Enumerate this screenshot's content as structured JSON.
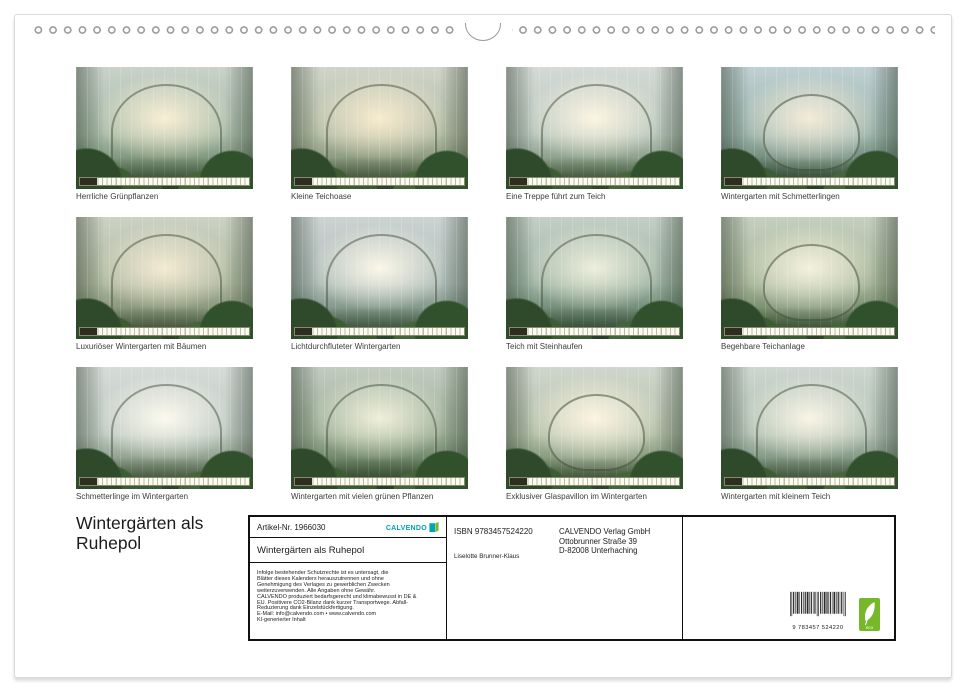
{
  "page": {
    "title_line1": "Wintergärten als",
    "title_line2": "Ruhepol"
  },
  "thumbnails": [
    {
      "caption": "Herrliche Grünpflanzen"
    },
    {
      "caption": "Kleine Teichoase"
    },
    {
      "caption": "Eine Treppe führt zum Teich"
    },
    {
      "caption": "Wintergarten mit Schmetterlingen"
    },
    {
      "caption": "Luxuriöser Wintergarten mit Bäumen"
    },
    {
      "caption": "Lichtdurchfluteter Wintergarten"
    },
    {
      "caption": "Teich mit Steinhaufen"
    },
    {
      "caption": "Begehbare Teichanlage"
    },
    {
      "caption": "Schmetterlinge im Wintergarten"
    },
    {
      "caption": "Wintergarten mit vielen grünen Pflanzen"
    },
    {
      "caption": "Exklusiver Glaspavillon im Wintergarten"
    },
    {
      "caption": "Wintergarten mit kleinem Teich"
    }
  ],
  "info_box": {
    "artikel_nr": "Artikel-Nr. 1966030",
    "logo_text": "CALVENDO",
    "calendar_title": "Wintergärten als Ruhepol",
    "legal_lines": [
      "Infolge bestehender Schutzrechte ist es untersagt, die",
      "Blätter dieses Kalenders herauszutrennen und ohne",
      "Genehmigung des Verlages zu gewerblichen Zwecken",
      "weiterzuverwenden. Alle Angaben ohne Gewähr.",
      "CALVENDO produziert bedarfsgerecht und klimabewusst in DE &",
      "EU. Positivere CO2-Bilanz dank kurzer Transportwege. Abfall-",
      "Reduzierung dank Einzelstückfertigung.",
      "E-Mail: info@calvendo.com • www.calvendo.com",
      "KI-generierter Inhalt"
    ],
    "isbn": "ISBN 9783457524220",
    "publisher_line1": "CALVENDO Verlag GmbH",
    "publisher_line2": "Ottobrunner Straße 39",
    "publisher_line3": "D-82008 Unterhaching",
    "author": "Liselotte Brunner-Klaus",
    "barcode_text": "9 783457 524220",
    "eco_label": "eco"
  },
  "colors": {
    "calvendo_teal": "#00a5b5",
    "eco_green": "#76b82a",
    "box_border": "#111111"
  }
}
